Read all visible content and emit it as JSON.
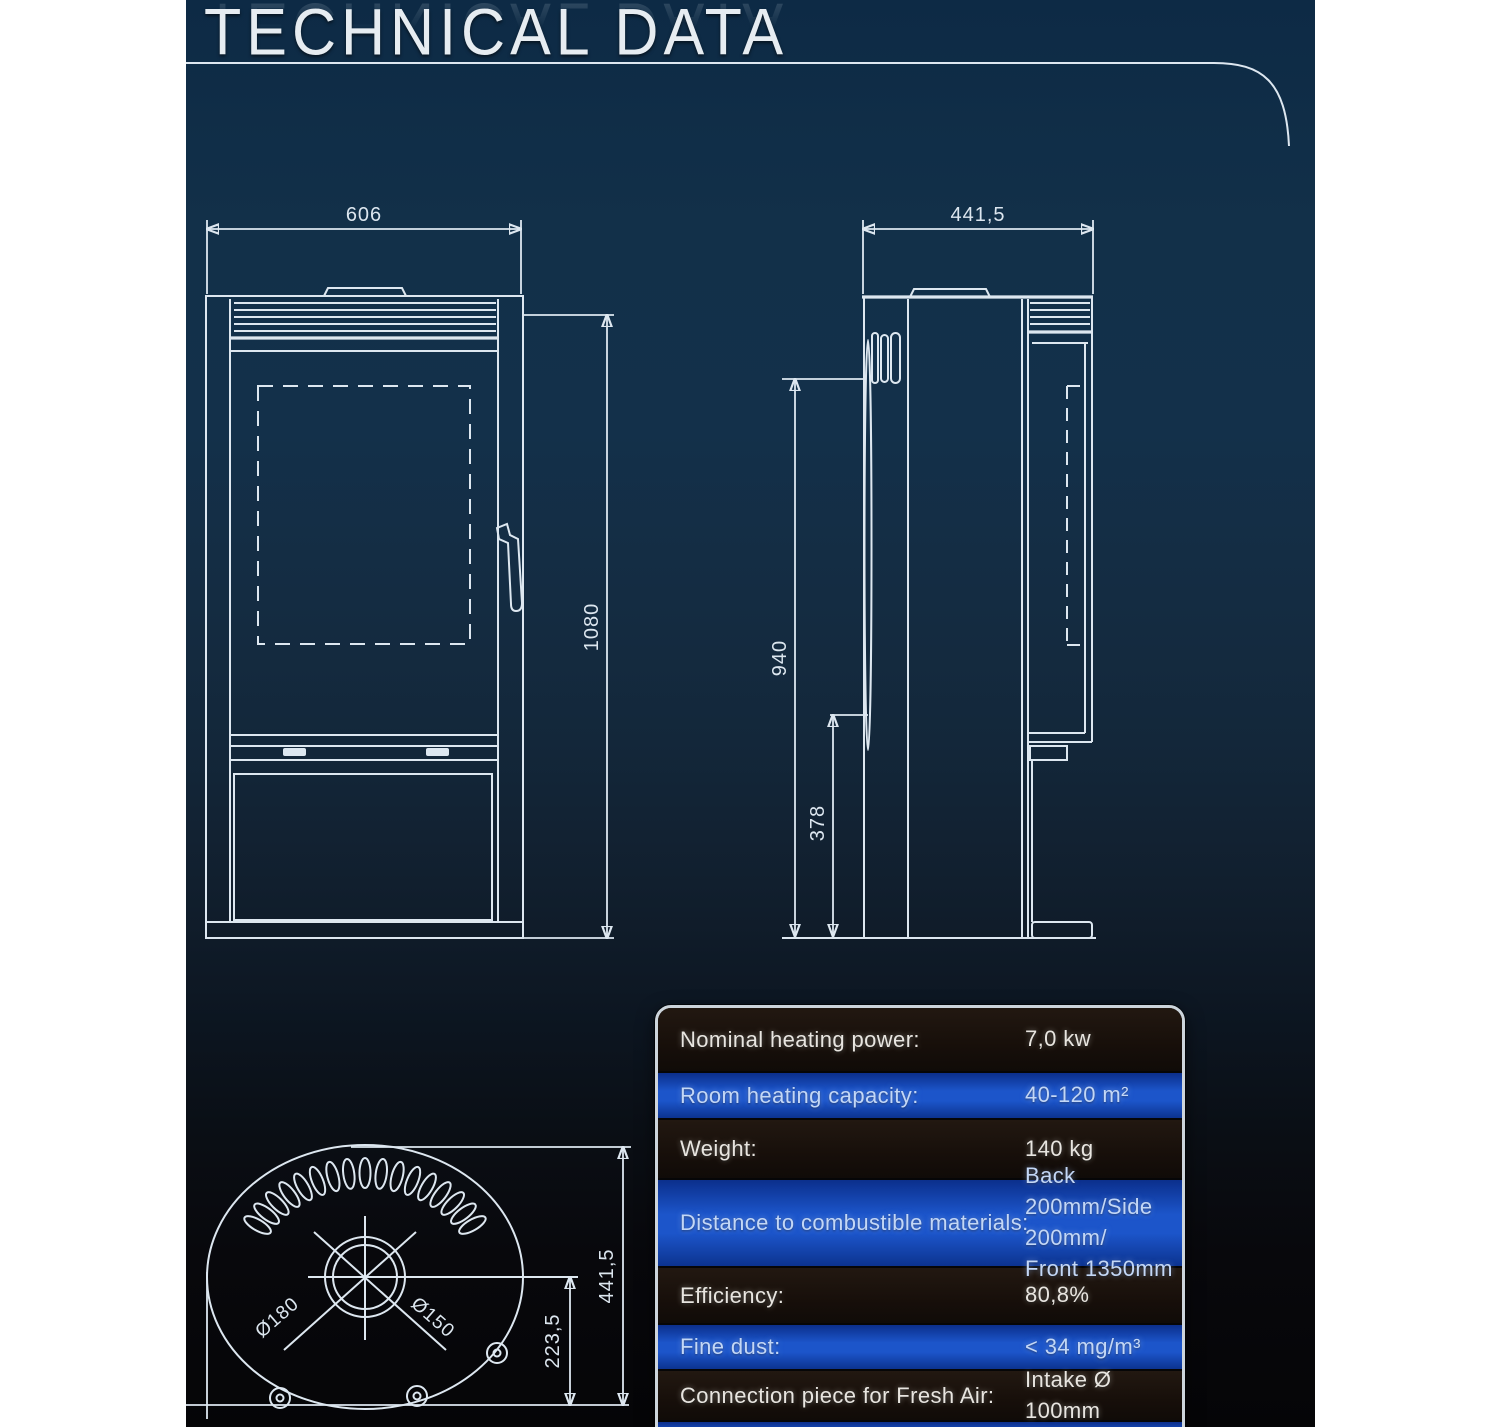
{
  "page": {
    "title": "TECHNICAL DATA"
  },
  "drawings": {
    "front_view": {
      "width": "606",
      "height": "1080"
    },
    "side_view": {
      "depth": "441,5",
      "height": "940",
      "plinth_height": "378"
    },
    "top_view": {
      "height": "441,5",
      "center_to_back": "223,5",
      "flue_outer_diameter": "Ø180",
      "flue_inner_diameter": "Ø150"
    }
  },
  "spec_table": {
    "rows": [
      {
        "label": "Nominal heating power:",
        "value": "7,0 kw"
      },
      {
        "label": "Room heating capacity:",
        "value": "40-120 m²"
      },
      {
        "label": "Weight:",
        "value": "140 kg"
      },
      {
        "label": "Distance to combustible materials:",
        "value": "Back 200mm/Side 200mm/\nFront 1350mm"
      },
      {
        "label": "Efficiency:",
        "value": "80,8%"
      },
      {
        "label": "Fine dust:",
        "value": "< 34 mg/m³"
      },
      {
        "label": "Connection piece for Fresh Air:",
        "value": "Intake Ø 100mm"
      },
      {
        "label": "",
        "value": ""
      }
    ]
  },
  "colors": {
    "accent_blue": "#1c55ca",
    "row_dark": "#170f0a",
    "drawing_line": "#dde7f0",
    "swoosh": "#7595ad",
    "background_top": "#0d2a45",
    "background_bottom": "#050507"
  }
}
